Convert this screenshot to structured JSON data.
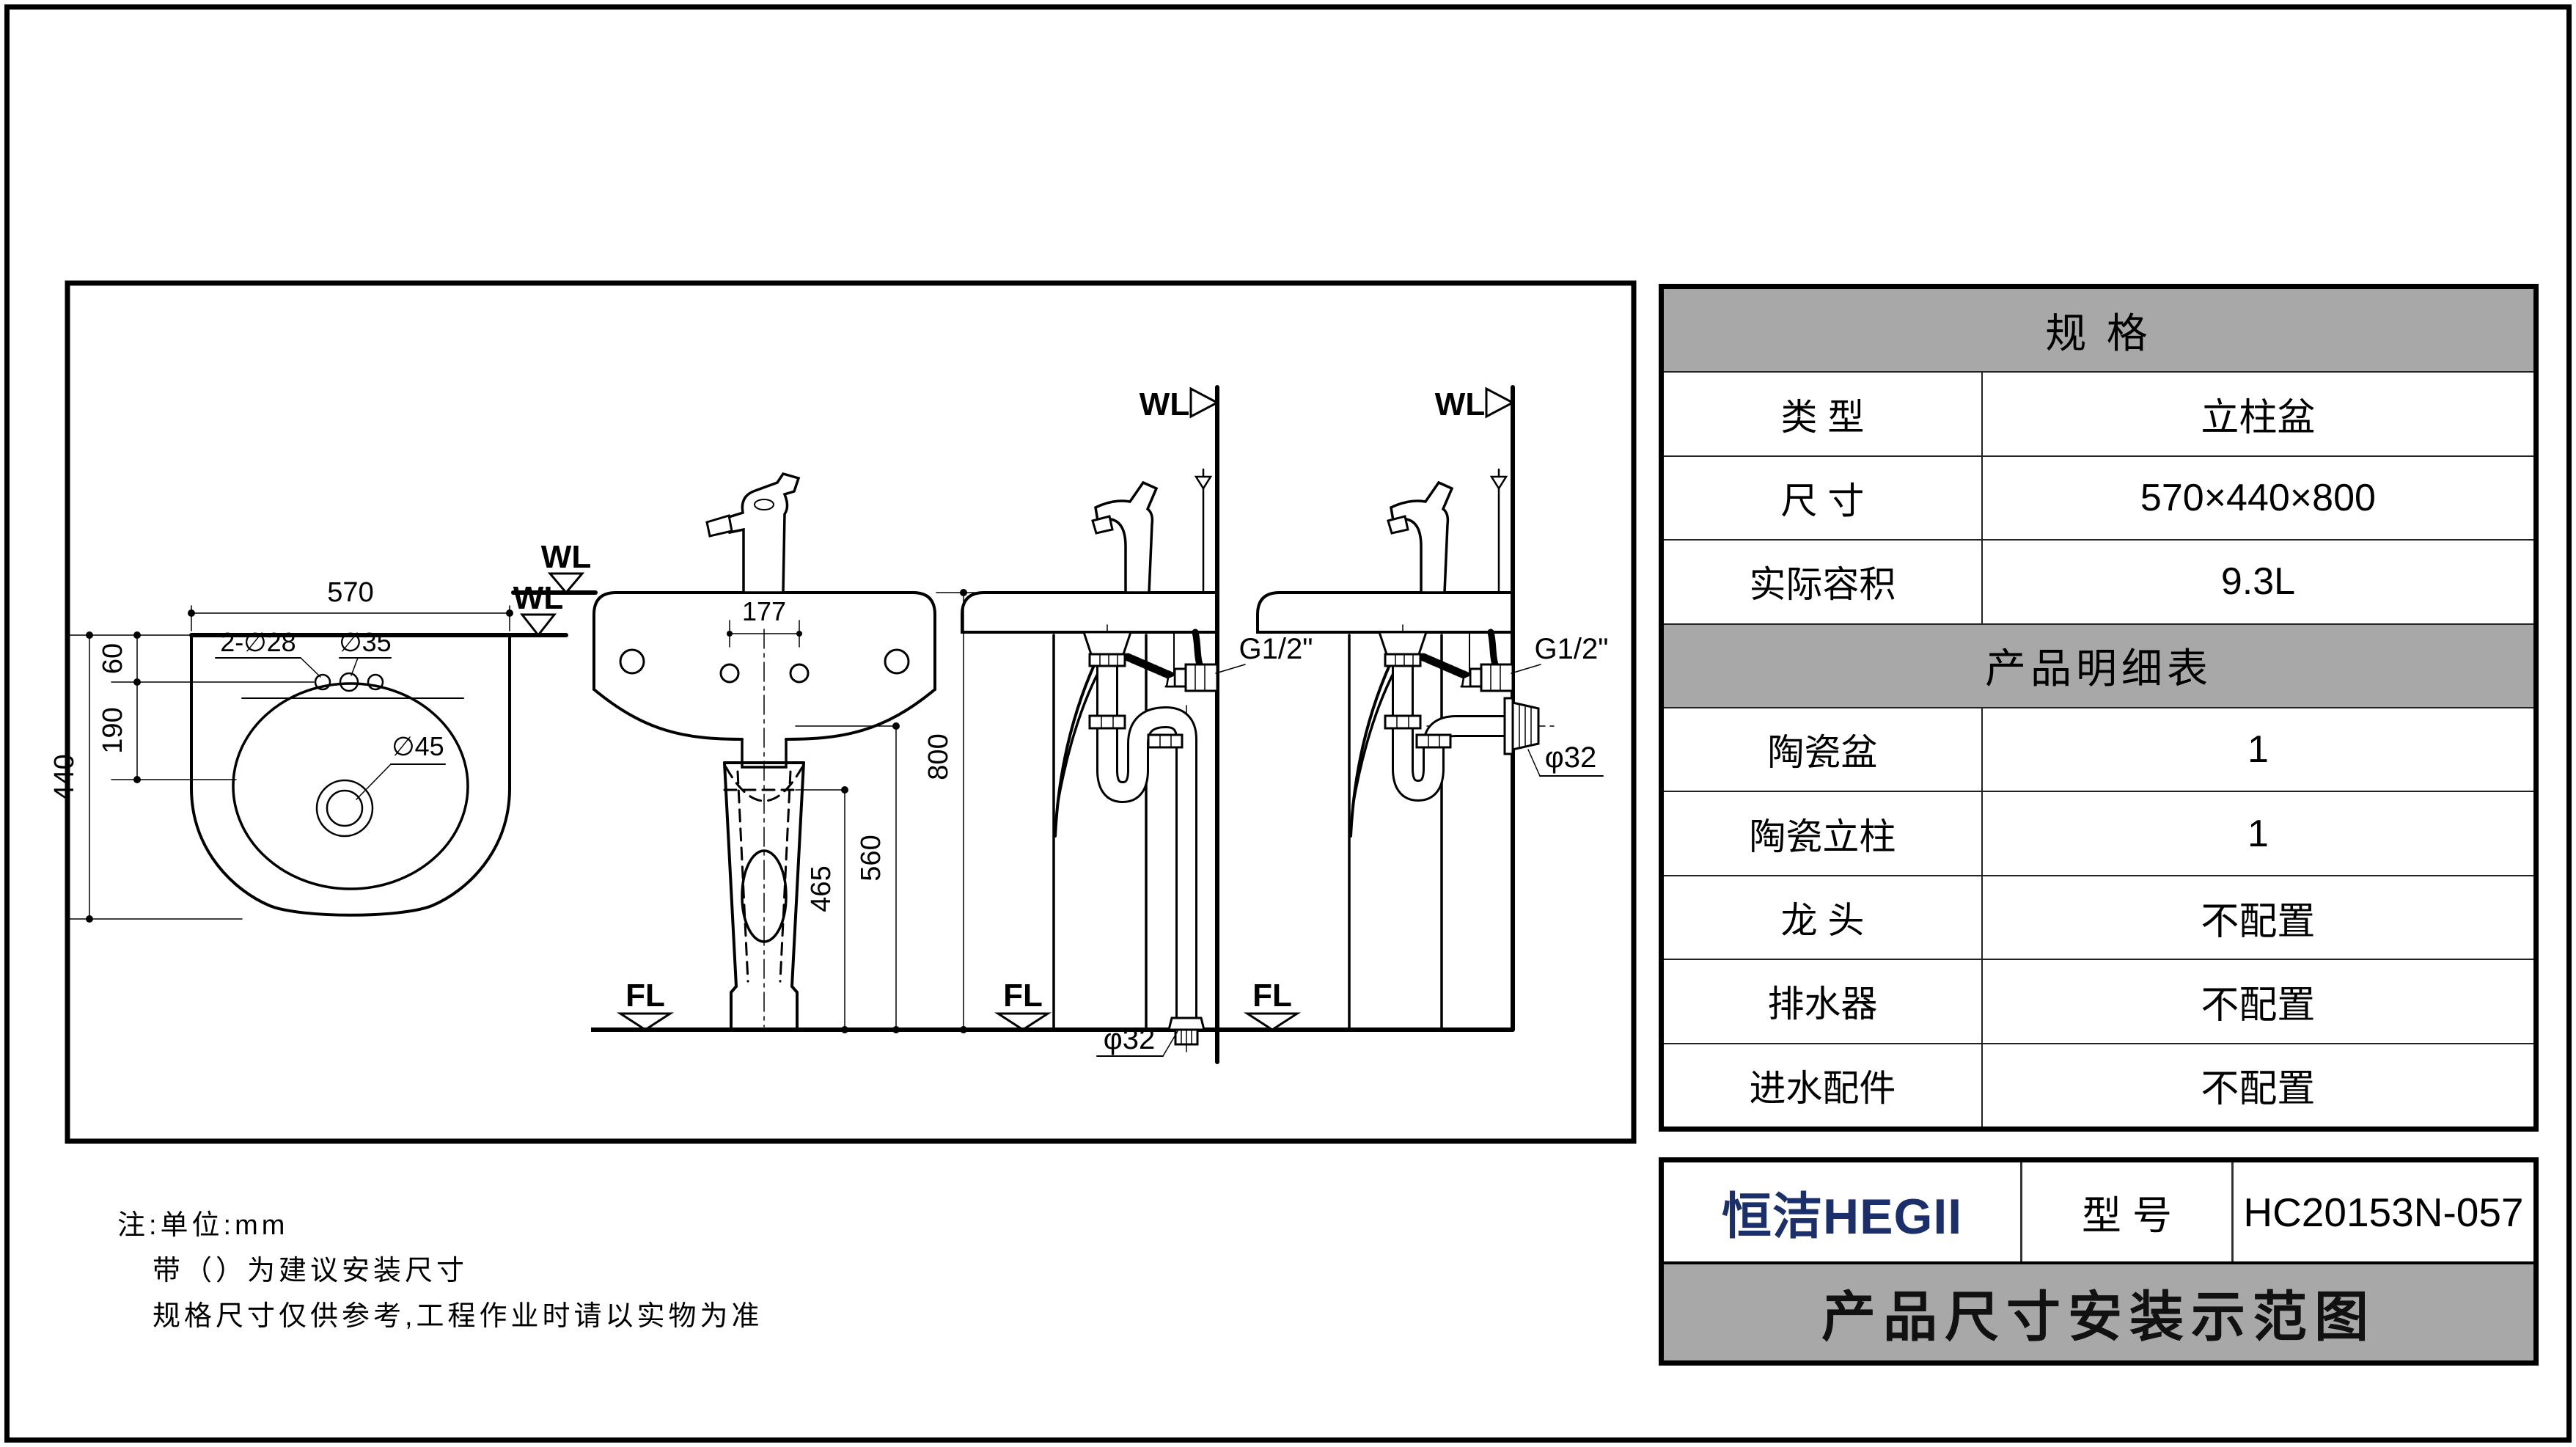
{
  "colors": {
    "header_gray": "#a8a8a8",
    "brand_navy": "#1b2f6b",
    "line_black": "#000000"
  },
  "spec_table": {
    "header1": "规  格",
    "rows1": [
      {
        "label": "类  型",
        "value": "立柱盆"
      },
      {
        "label": "尺  寸",
        "value": "570×440×800"
      },
      {
        "label": "实际容积",
        "value": "9.3L"
      }
    ],
    "header2": "产品明细表",
    "rows2": [
      {
        "label": "陶瓷盆",
        "value": "1"
      },
      {
        "label": "陶瓷立柱",
        "value": "1"
      },
      {
        "label": "龙  头",
        "value": "不配置"
      },
      {
        "label": "排水器",
        "value": "不配置"
      },
      {
        "label": "进水配件",
        "value": "不配置"
      }
    ]
  },
  "title_block": {
    "brand": "恒洁HEGII",
    "model_label": "型  号",
    "model_value": "HC20153N-057",
    "banner": "产品尺寸安装示范图"
  },
  "notes": {
    "line1": "注:单位:mm",
    "line2": "带（）为建议安装尺寸",
    "line3": "规格尺寸仅供参考,工程作业时请以实物为准"
  },
  "drawing": {
    "top_view": {
      "dim_width": "570",
      "dim_edge": "60",
      "dim_center": "190",
      "dim_depth": "440",
      "label_holes": "2-∅28",
      "label_mid_hole": "∅35",
      "label_drain": "∅45",
      "marker_wl": "WL"
    },
    "front_view": {
      "dim_spacing": "177",
      "dim_height": "800",
      "dim_560": "560",
      "dim_465": "465",
      "marker_wl": "WL",
      "marker_fl_left": "FL",
      "marker_fl_right": "FL"
    },
    "side_view_floor_drain": {
      "marker_wl": "WL",
      "marker_fl": "FL",
      "label_valve": "G1/2\"",
      "label_drain": "φ32"
    },
    "side_view_wall_drain": {
      "marker_wl": "WL",
      "label_valve": "G1/2\"",
      "label_drain": "φ32"
    }
  }
}
